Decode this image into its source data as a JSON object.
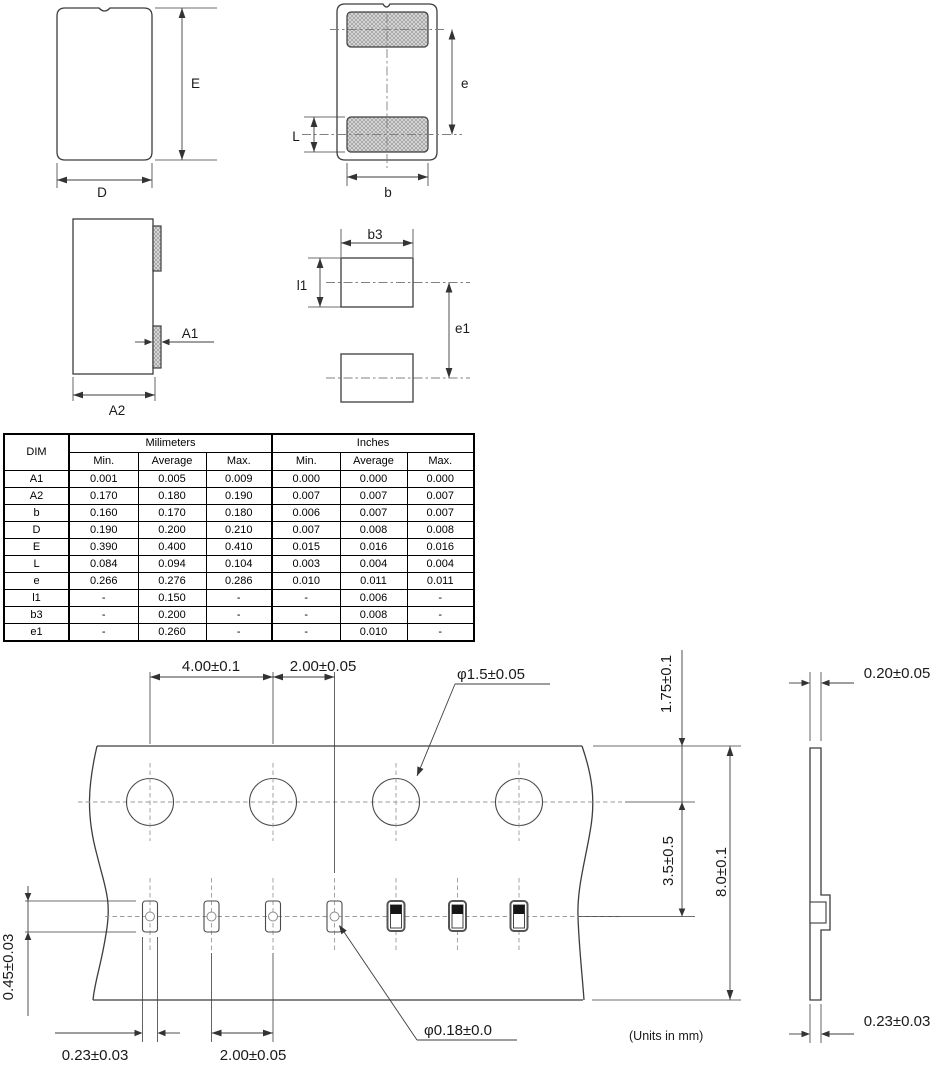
{
  "labels": {
    "top_view": {
      "E": "E",
      "D": "D"
    },
    "pad_view": {
      "e": "e",
      "L": "L",
      "b": "b"
    },
    "side_view": {
      "A1": "A1",
      "A2": "A2"
    },
    "land_pattern": {
      "b3": "b3",
      "l1": "l1",
      "e1": "e1"
    }
  },
  "table": {
    "dim": "DIM",
    "millimeters": "Milimeters",
    "inches": "Inches",
    "sub": [
      "Min.",
      "Average",
      "Max.",
      "Min.",
      "Average",
      "Max."
    ],
    "rows": [
      {
        "d": "A1",
        "c": [
          "0.001",
          "0.005",
          "0.009",
          "0.000",
          "0.000",
          "0.000"
        ]
      },
      {
        "d": "A2",
        "c": [
          "0.170",
          "0.180",
          "0.190",
          "0.007",
          "0.007",
          "0.007"
        ]
      },
      {
        "d": "b",
        "c": [
          "0.160",
          "0.170",
          "0.180",
          "0.006",
          "0.007",
          "0.007"
        ]
      },
      {
        "d": "D",
        "c": [
          "0.190",
          "0.200",
          "0.210",
          "0.007",
          "0.008",
          "0.008"
        ]
      },
      {
        "d": "E",
        "c": [
          "0.390",
          "0.400",
          "0.410",
          "0.015",
          "0.016",
          "0.016"
        ]
      },
      {
        "d": "L",
        "c": [
          "0.084",
          "0.094",
          "0.104",
          "0.003",
          "0.004",
          "0.004"
        ]
      },
      {
        "d": "e",
        "c": [
          "0.266",
          "0.276",
          "0.286",
          "0.010",
          "0.011",
          "0.011"
        ]
      },
      {
        "d": "l1",
        "c": [
          "-",
          "0.150",
          "-",
          "-",
          "0.006",
          "-"
        ]
      },
      {
        "d": "b3",
        "c": [
          "-",
          "0.200",
          "-",
          "-",
          "0.008",
          "-"
        ]
      },
      {
        "d": "e1",
        "c": [
          "-",
          "0.260",
          "-",
          "-",
          "0.010",
          "-"
        ]
      }
    ]
  },
  "tape": {
    "sprocket_pitch": "4.00±0.1",
    "sprocket_to_pocket": "2.00±0.05",
    "sprocket_hole_dia": "φ1.5±0.05",
    "edge_to_sprocket": "1.75±0.1",
    "sprocket_to_pocket_line": "3.5±0.5",
    "tape_width": "8.0±0.1",
    "pocket_length": "0.45±0.03",
    "pocket_width": "0.23±0.03",
    "pocket_pitch": "2.00±0.05",
    "center_hole_dia": "φ0.18±0.0",
    "units_note": "(Units in mm)"
  },
  "tape_section": {
    "top_thickness": "0.20±0.05",
    "bottom_thickness": "0.23±0.03"
  },
  "colors": {
    "line": "#3d3d3d",
    "hatch_fill": "#d9d9d9",
    "text": "#1a1a1a"
  }
}
